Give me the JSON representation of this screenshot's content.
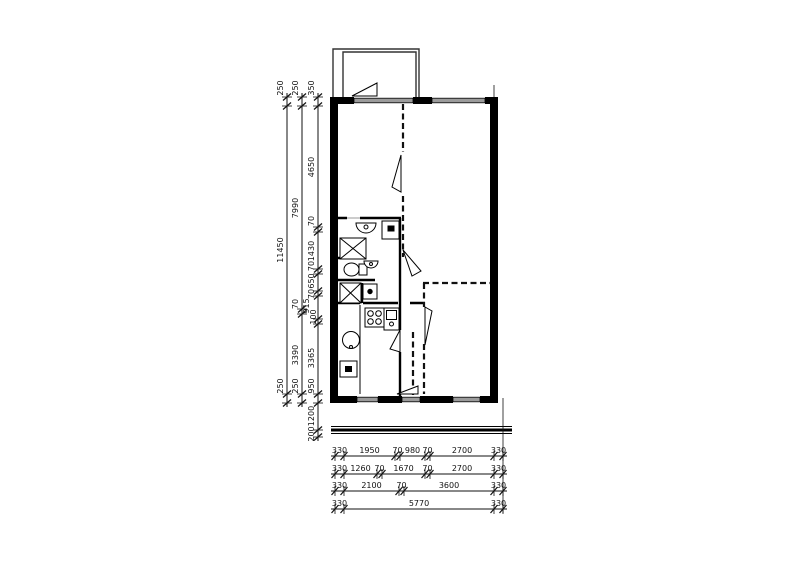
{
  "drawing": {
    "type": "apartment-floor-plan",
    "colors": {
      "wall": "#000000",
      "window_fill": "#9b9b9b",
      "line": "#111111",
      "background": "#ffffff"
    },
    "dimensions_left": [
      {
        "id": "chain-outer",
        "labels": [
          "250",
          "11450",
          "250"
        ]
      },
      {
        "id": "chain-middle",
        "labels": [
          "250",
          "7990",
          "70",
          "3390",
          "250"
        ]
      },
      {
        "id": "chain-inner",
        "labels": [
          "350",
          "4650",
          "70",
          "1430",
          "70",
          "650",
          "70",
          "915",
          "100",
          "3365",
          "950",
          "1200",
          "200"
        ]
      }
    ],
    "dimensions_bottom": [
      {
        "id": "row-1",
        "labels": [
          "330",
          "1950",
          "70",
          "980",
          "70",
          "2700",
          "330"
        ]
      },
      {
        "id": "row-2",
        "labels": [
          "330",
          "1260",
          "70",
          "1670",
          "70",
          "2700",
          "330"
        ]
      },
      {
        "id": "row-3",
        "labels": [
          "330",
          "2100",
          "70",
          "3600",
          "330"
        ]
      },
      {
        "id": "row-4",
        "labels": [
          "330",
          "5770",
          "330"
        ]
      }
    ],
    "fixtures": [
      "washbasin",
      "washing-machine",
      "shower",
      "toilet",
      "hand-basin",
      "storage-cabinet",
      "stove",
      "kitchen-sink",
      "round-sink",
      "appliance"
    ]
  }
}
